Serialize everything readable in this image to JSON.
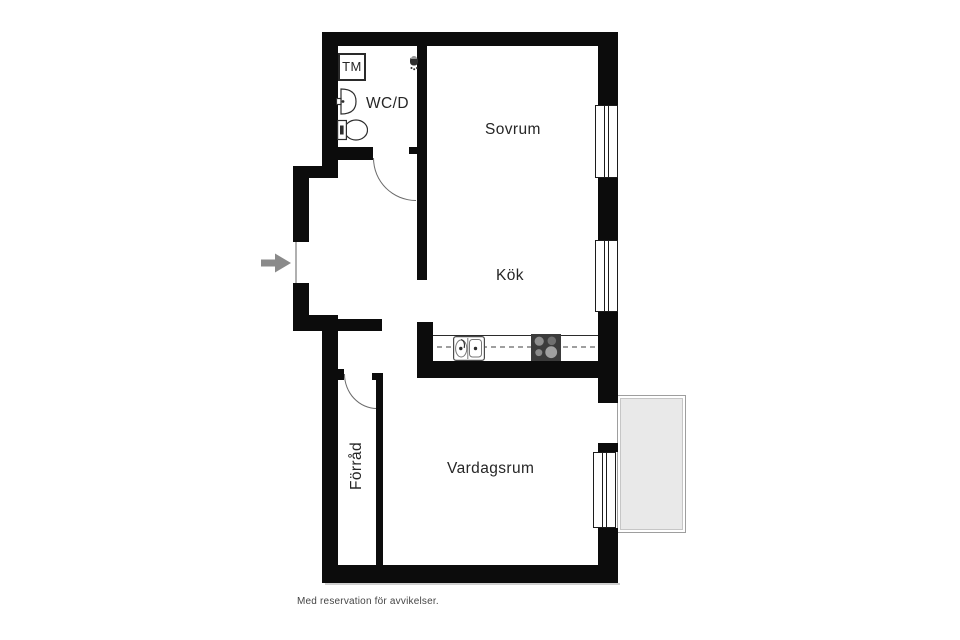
{
  "rooms": {
    "bedroom": "Sovrum",
    "kitchen": "Kök",
    "wc": "WC/D",
    "storage": "Förråd",
    "living_room": "Vardagsrum"
  },
  "appliances": {
    "washing_machine": "TM"
  },
  "footer": {
    "disclaimer": "Med reservation för avvikelser."
  },
  "icons": {
    "entry": "entry-arrow-icon",
    "shower": "shower-icon",
    "washbasin": "washbasin-icon",
    "toilet": "toilet-icon",
    "kitchen_sink": "kitchen-sink-icon",
    "stove": "stove-icon"
  },
  "colors": {
    "wall": "#0c0c0c",
    "room_label": "#262626",
    "entry_arrow": "#8a8a8a",
    "door_swing": "#6a6a6a",
    "entrance_door": "#b0b0b0",
    "counter_dash": "#9f9f9f",
    "stove": "#3b3b3b",
    "burner": "#8f8f8f",
    "balcony_fill": "#e9e9e9",
    "balcony_border": "#9e9e9e",
    "footer_text": "#454545",
    "fixture_stroke": "#2e2e2e"
  }
}
